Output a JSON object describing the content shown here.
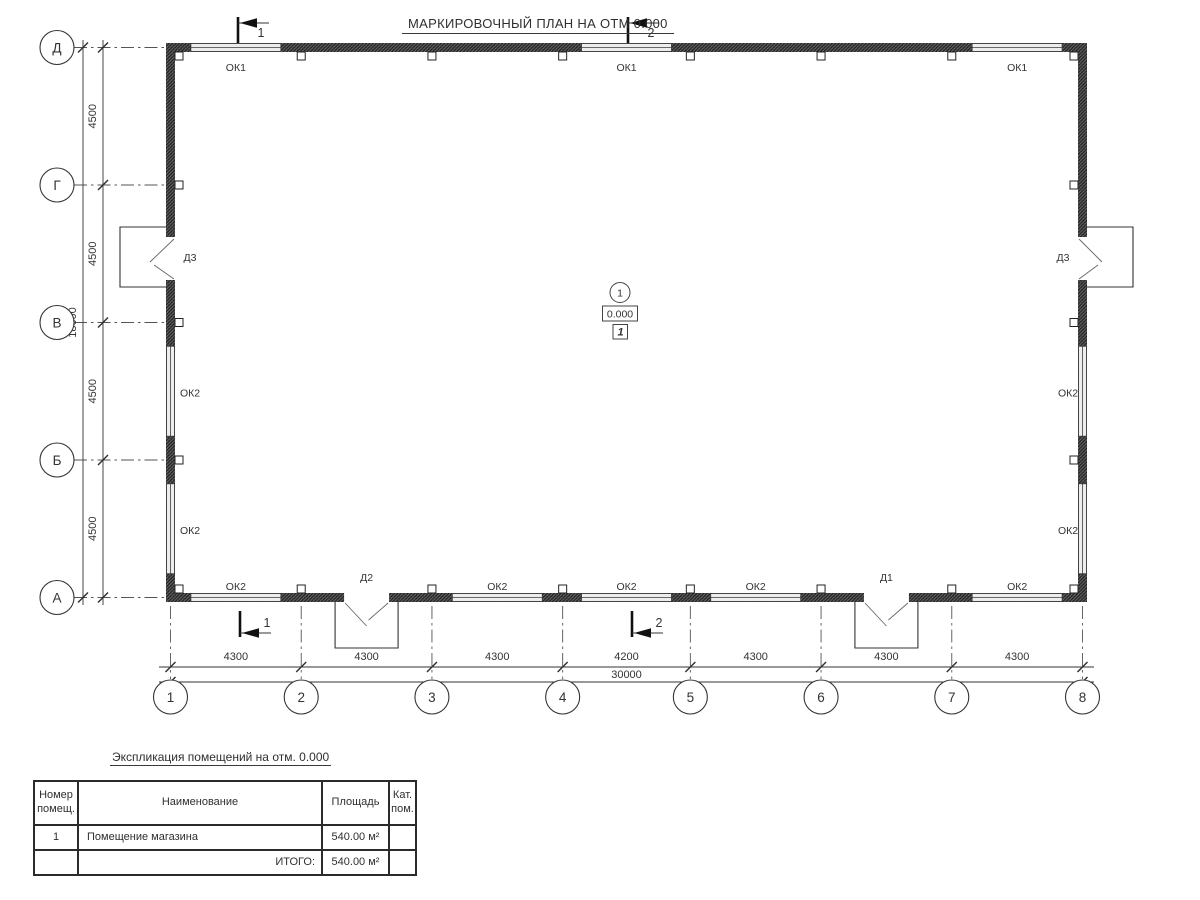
{
  "title": "МАРКИРОВОЧНЫЙ ПЛАН НА ОТМ 0.000",
  "plan": {
    "col_axes": [
      "1",
      "2",
      "3",
      "4",
      "5",
      "6",
      "7",
      "8"
    ],
    "row_axes": [
      "Д",
      "Г",
      "В",
      "Б",
      "А"
    ],
    "col_dims": [
      "4300",
      "4300",
      "4300",
      "4200",
      "4300",
      "4300",
      "4300"
    ],
    "row_dims": [
      "4500",
      "4500",
      "4500",
      "4500"
    ],
    "total_width": "30000",
    "total_height": "18000",
    "windows": {
      "top": [
        {
          "bay": [
            0,
            1
          ],
          "label": "ОК1"
        },
        {
          "bay": [
            3,
            4
          ],
          "label": "ОК1"
        },
        {
          "bay": [
            6,
            7
          ],
          "label": "ОК1"
        }
      ],
      "bottom": [
        {
          "bay": [
            0,
            1
          ],
          "label": "ОК2"
        },
        {
          "bay": [
            2,
            3
          ],
          "label": "ОК2"
        },
        {
          "bay": [
            3,
            4
          ],
          "label": "ОК2"
        },
        {
          "bay": [
            4,
            5
          ],
          "label": "ОК2"
        },
        {
          "bay": [
            6,
            7
          ],
          "label": "ОК2"
        }
      ],
      "left": [
        {
          "bay": [
            2,
            3
          ],
          "label": "ОК2"
        },
        {
          "bay": [
            3,
            4
          ],
          "label": "ОК2"
        }
      ],
      "right": [
        {
          "bay": [
            2,
            3
          ],
          "label": "ОК2"
        },
        {
          "bay": [
            3,
            4
          ],
          "label": "ОК2"
        }
      ]
    },
    "doors": {
      "bottom": [
        {
          "bay": [
            1,
            2
          ],
          "label": "Д2"
        },
        {
          "bay": [
            5,
            6
          ],
          "label": "Д1"
        }
      ],
      "left": [
        {
          "label": "Д3"
        }
      ],
      "right": [
        {
          "label": "Д3"
        }
      ]
    },
    "section_markers": [
      "1",
      "2"
    ],
    "room_marker": {
      "number": "1",
      "elevation": "0.000",
      "category": "1"
    }
  },
  "table": {
    "title": "Экспликация помещений на отм. 0.000",
    "headers": [
      "Номер\nпомещ.",
      "Наименование",
      "Площадь",
      "Кат.\nпом."
    ],
    "rows": [
      [
        "1",
        "Помещение магазина",
        "540.00 м²",
        ""
      ]
    ],
    "total_label": "ИТОГО:",
    "total_value": "540.00 м²"
  }
}
